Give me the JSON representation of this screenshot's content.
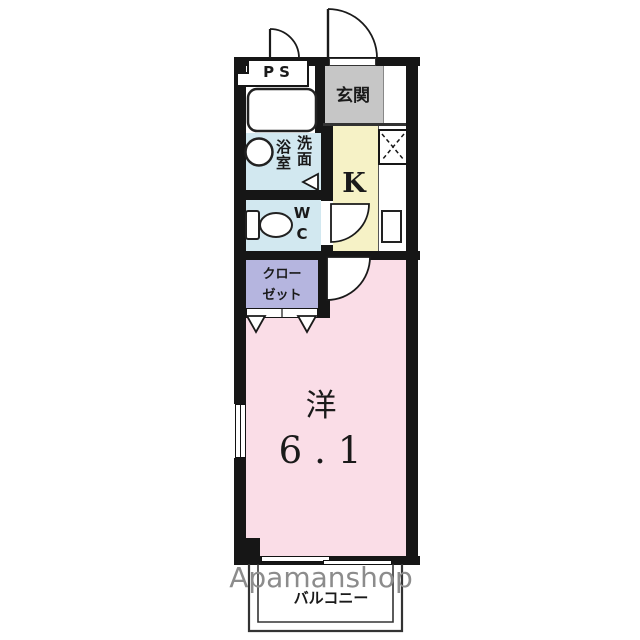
{
  "plan": {
    "title": "apartment-floor-plan",
    "rooms": {
      "ps": {
        "label": "PS"
      },
      "genkan": {
        "label": "玄関"
      },
      "bath": {
        "label": "浴室"
      },
      "washroom": {
        "label": "洗面"
      },
      "wc": {
        "label": "WC"
      },
      "kitchen": {
        "label": "K"
      },
      "closet": {
        "label": "クローゼット",
        "line1": "クロー",
        "line2": "ゼット"
      },
      "main_room": {
        "label": "洋",
        "size": "6.1"
      },
      "balcony": {
        "label": "バルコニー"
      }
    }
  },
  "watermark": {
    "text": "Apamanshop"
  },
  "colors": {
    "wall": "#161616",
    "genkan": "#c6c6c6",
    "kitchen": "#f6f2c6",
    "water": "#d2e8f0",
    "closet": "#b5b5df",
    "room": "#fadde7",
    "watermark_gray": "#8c8c8c"
  }
}
